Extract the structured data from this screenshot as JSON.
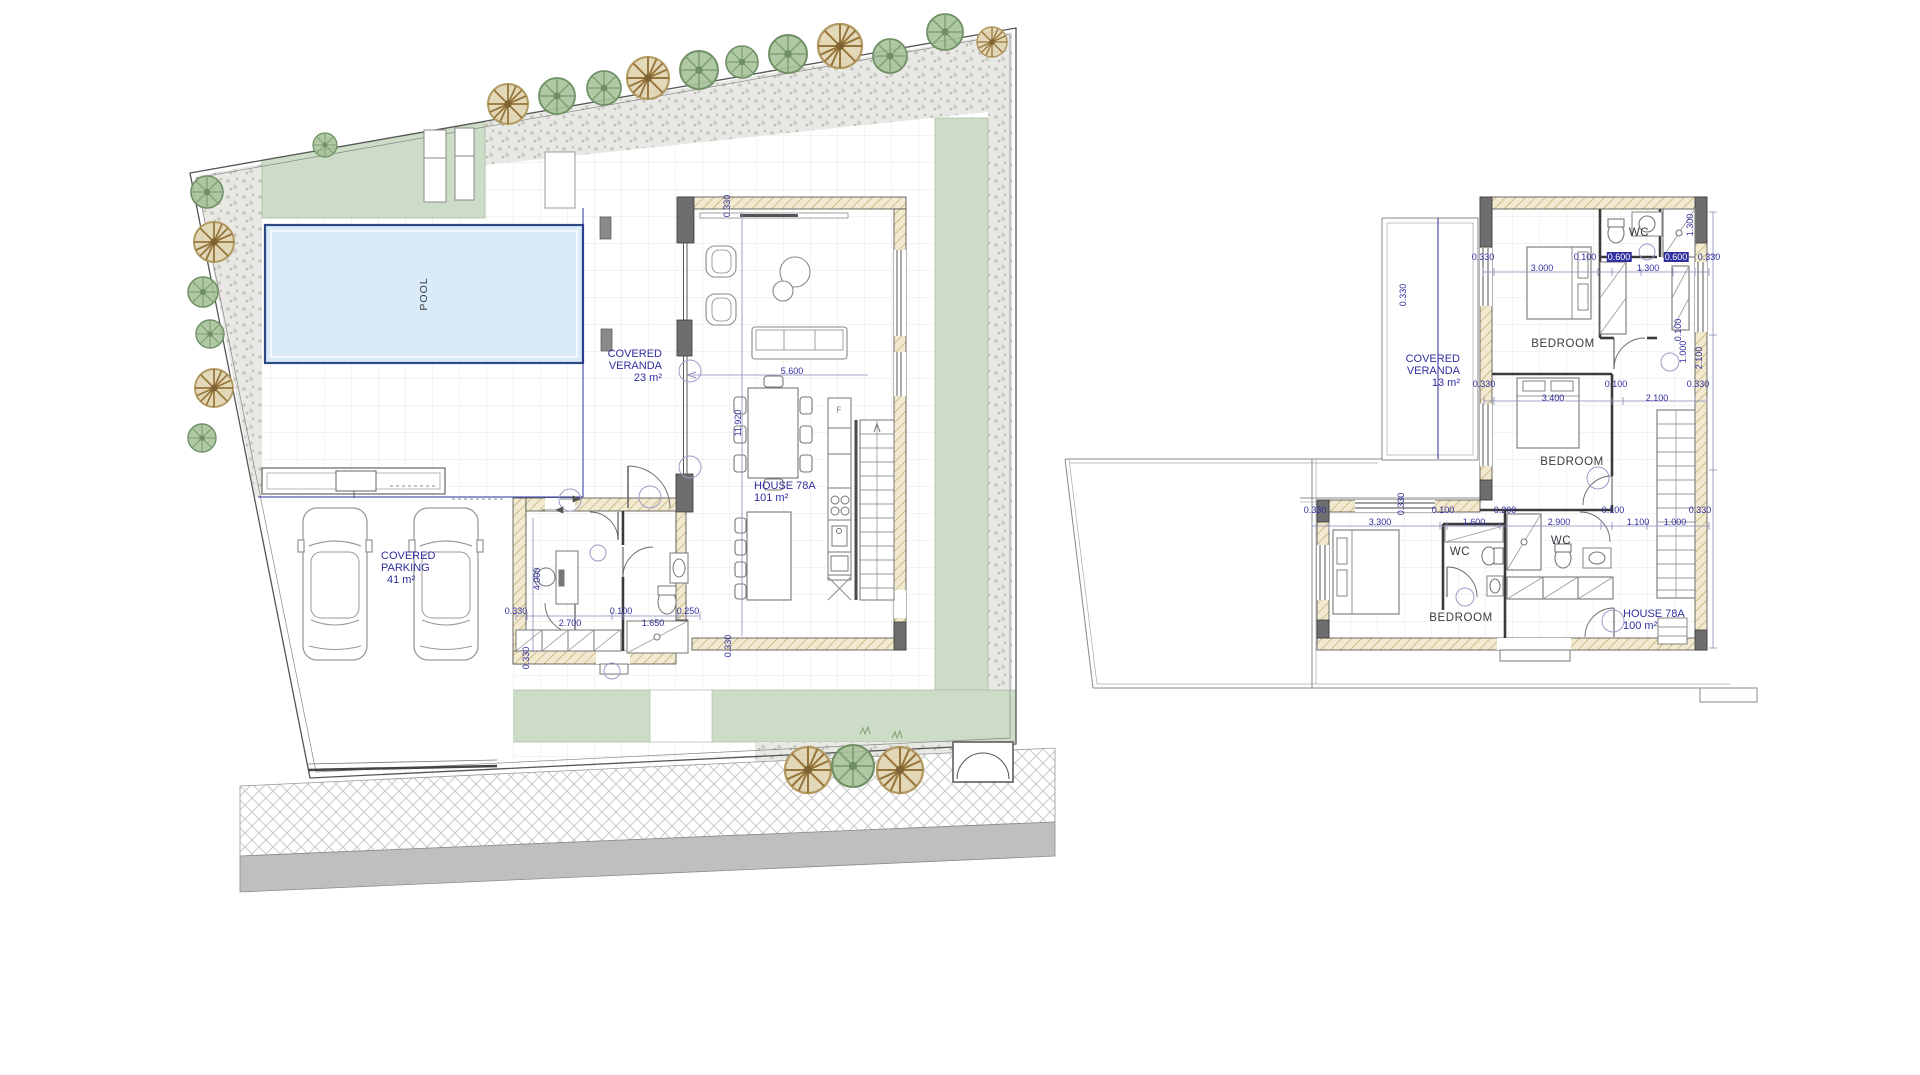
{
  "ground_floor": {
    "pool_label": "POOL",
    "veranda": {
      "line1": "COVERED",
      "line2": "VERANDA",
      "area": "23 m²"
    },
    "house": {
      "name": "HOUSE 78A",
      "area": "101 m²"
    },
    "parking": {
      "line1": "COVERED",
      "line2": "PARKING",
      "area": "41 m²"
    },
    "annotations": [
      {
        "t": "F",
        "x": 839,
        "y": 410
      }
    ],
    "dimensions": [
      {
        "t": "0.330",
        "x": 727,
        "y": 206,
        "rot": 1
      },
      {
        "t": "5.600",
        "x": 792,
        "y": 371
      },
      {
        "t": "11.920",
        "x": 738,
        "y": 423,
        "rot": 1
      },
      {
        "t": "0.330",
        "x": 516,
        "y": 611
      },
      {
        "t": "0.100",
        "x": 621,
        "y": 611
      },
      {
        "t": "0.250",
        "x": 688,
        "y": 611
      },
      {
        "t": "2.700",
        "x": 570,
        "y": 623
      },
      {
        "t": "1.650",
        "x": 653,
        "y": 623
      },
      {
        "t": "4.000",
        "x": 537,
        "y": 579,
        "rot": 1
      },
      {
        "t": "0.330",
        "x": 526,
        "y": 658,
        "rot": 1
      },
      {
        "t": "0.330",
        "x": 728,
        "y": 646,
        "rot": 1
      }
    ]
  },
  "first_floor": {
    "veranda": {
      "line1": "COVERED",
      "line2": "VERANDA",
      "area": "13 m²"
    },
    "house": {
      "name": "HOUSE 78A",
      "area": "100 m²"
    },
    "rooms": [
      {
        "t": "BEDROOM",
        "x": 1563,
        "y": 344
      },
      {
        "t": "BEDROOM",
        "x": 1572,
        "y": 462
      },
      {
        "t": "BEDROOM",
        "x": 1461,
        "y": 618
      },
      {
        "t": "WC",
        "x": 1639,
        "y": 233
      },
      {
        "t": "WC",
        "x": 1561,
        "y": 541
      },
      {
        "t": "WC",
        "x": 1460,
        "y": 552
      }
    ],
    "dimensions": [
      {
        "t": "0.330",
        "x": 1483,
        "y": 257
      },
      {
        "t": "0.100",
        "x": 1585,
        "y": 257
      },
      {
        "t": "0.600",
        "x": 1619,
        "y": 257,
        "hl": 1
      },
      {
        "t": "0.600",
        "x": 1676,
        "y": 257,
        "hl": 1
      },
      {
        "t": "0.330",
        "x": 1709,
        "y": 257
      },
      {
        "t": "3.000",
        "x": 1542,
        "y": 268
      },
      {
        "t": "1.300",
        "x": 1648,
        "y": 268
      },
      {
        "t": "1.300",
        "x": 1690,
        "y": 225,
        "rot": 1
      },
      {
        "t": "2.100",
        "x": 1699,
        "y": 358,
        "rot": 1
      },
      {
        "t": "0.100",
        "x": 1678,
        "y": 330,
        "rot": 1
      },
      {
        "t": "1.000",
        "x": 1683,
        "y": 352,
        "rot": 1
      },
      {
        "t": "0.330",
        "x": 1403,
        "y": 295,
        "rot": 1
      },
      {
        "t": "0.330",
        "x": 1484,
        "y": 384
      },
      {
        "t": "0.100",
        "x": 1616,
        "y": 384
      },
      {
        "t": "0.330",
        "x": 1698,
        "y": 384
      },
      {
        "t": "3.400",
        "x": 1553,
        "y": 398
      },
      {
        "t": "2.100",
        "x": 1657,
        "y": 398
      },
      {
        "t": "0.330",
        "x": 1315,
        "y": 510
      },
      {
        "t": "0.100",
        "x": 1443,
        "y": 510
      },
      {
        "t": "0.200",
        "x": 1505,
        "y": 510
      },
      {
        "t": "0.100",
        "x": 1613,
        "y": 510
      },
      {
        "t": "0.330",
        "x": 1700,
        "y": 510
      },
      {
        "t": "3.300",
        "x": 1380,
        "y": 522
      },
      {
        "t": "1.600",
        "x": 1474,
        "y": 522
      },
      {
        "t": "2.900",
        "x": 1559,
        "y": 522
      },
      {
        "t": "1.100",
        "x": 1638,
        "y": 522
      },
      {
        "t": "1.000",
        "x": 1675,
        "y": 522
      },
      {
        "t": "0.330",
        "x": 1401,
        "y": 504,
        "rot": 1
      }
    ]
  },
  "colors": {
    "dimension_blue": "#2f2fa0",
    "pool_fill": "#d9eaf8",
    "pool_border": "#2c4a86",
    "lawn_green": "#ccdcc6",
    "wall_hatch": "#f2ead0",
    "road_gray": "#bfbfbf"
  }
}
